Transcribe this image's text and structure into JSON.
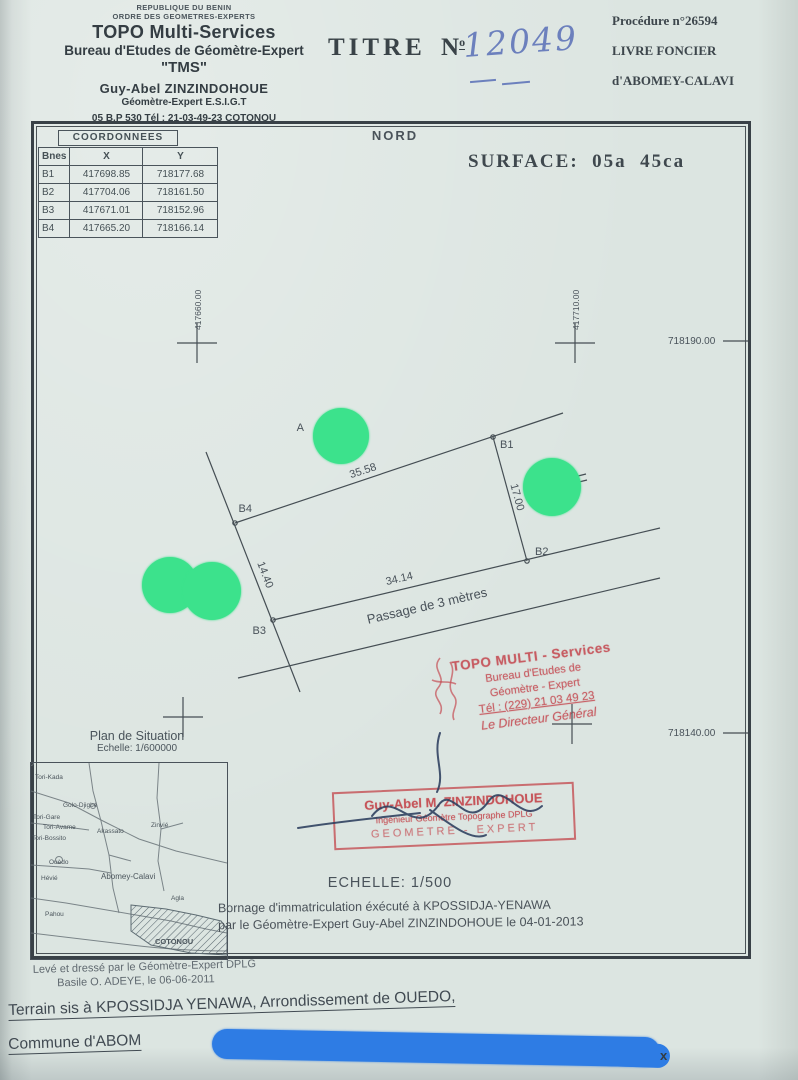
{
  "header": {
    "org_line1": "REPUBLIQUE DU BENIN",
    "org_line2": "ORDRE DES GEOMETRES-EXPERTS",
    "company": "TOPO Multi-Services",
    "bureau": "Bureau d'Etudes de Géomètre-Expert",
    "sigle": "\"TMS\"",
    "expert_name": "Guy-Abel ZINZINDOHOUE",
    "expert_title": "Géomètre-Expert  E.S.I.G.T",
    "address": "05 B.P 530   Tél : 21-03-49-23 COTONOU",
    "titre_label": "TITRE",
    "titre_no_letter": "N",
    "titre_no_sup": "o",
    "titre_number": "12049",
    "procedure": "Procédure  n°26594",
    "livre_line1": "LIVRE  FONCIER",
    "livre_line2": "d'ABOMEY-CALAVI"
  },
  "plan": {
    "nord": "NORD",
    "surface": "SURFACE:  05a  45ca",
    "coordinates_table": {
      "title": "COORDONNEES",
      "columns": [
        "Bnes",
        "X",
        "Y"
      ],
      "rows": [
        [
          "B1",
          "417698.85",
          "718177.68"
        ],
        [
          "B2",
          "417704.06",
          "718161.50"
        ],
        [
          "B3",
          "417671.01",
          "718152.96"
        ],
        [
          "B4",
          "417665.20",
          "718166.14"
        ]
      ]
    },
    "grid_labels": {
      "east_left": "417660.00",
      "east_right": "417710.00",
      "north_top": "718190.00",
      "north_bottom": "718140.00"
    },
    "parcel": {
      "corner_b1": "B1",
      "corner_b2": "B2",
      "corner_b3": "B3",
      "corner_b4": "B4",
      "len_top": "35.58",
      "len_right": "17.00",
      "len_bottom": "34.14",
      "len_left": "14.40",
      "passage_label": "Passage de 3 mètres",
      "point_a_label": "A"
    },
    "situation": {
      "title": "Plan de Situation",
      "scale": "Echelle: 1/600000",
      "places": {
        "tori_kada": "Tori-Kada",
        "golo_djigbe": "Golo-Djigbé",
        "tori_gare": "Tori-Gare",
        "tori_avame": "Tori-Avame",
        "tori_bossito": "Tori-Bossito",
        "akassato": "Akassato",
        "zinvie": "Zinvié",
        "ouedo": "Ouèdo",
        "hevie": "Hévié",
        "abomey_calavi": "Abomey-Calavi",
        "agla": "Agla",
        "pahou": "Pahou",
        "cotonou": "COTONOU"
      }
    },
    "scale_label": "ECHELLE: 1/500",
    "bornage_line1": "Bornage d'immatriculation éxécuté à KPOSSIDJA-YENAWA",
    "bornage_line2": "par le Géomètre-Expert Guy-Abel ZINZINDOHOUE le 04-01-2013"
  },
  "stamps": {
    "stamp1": {
      "line1": "TOPO MULTI - Services",
      "line2": "Bureau d'Etudes de",
      "line3": "Géomètre - Expert",
      "line4": "Tél : (229) 21 03 49 23",
      "line5": "Le Directeur Général"
    },
    "stamp2": {
      "line1": "Guy-Abel M. ZINZINDOHOUE",
      "line2": "Ingénieur Géomètre Topographe DPLG",
      "line3": "GEOMETRE - EXPERT"
    }
  },
  "footer": {
    "leve_line1": "Levé et dressé par le Géomètre-Expert DPLG",
    "leve_line2": "Basile O. ADEYE, le 06-06-2011",
    "terrain": "Terrain sis à KPOSSIDJA YENAWA, Arrondissement de OUEDO,",
    "commune": "Commune d'ABOM",
    "redaction_x": "x"
  },
  "colors": {
    "paper": "#dce5e1",
    "ink": "#39424a",
    "stamp_red": "#c54d54",
    "redaction_green": "#3ce28c",
    "redaction_blue": "#2e7ce4",
    "handwriting_blue": "#6c80bd"
  }
}
